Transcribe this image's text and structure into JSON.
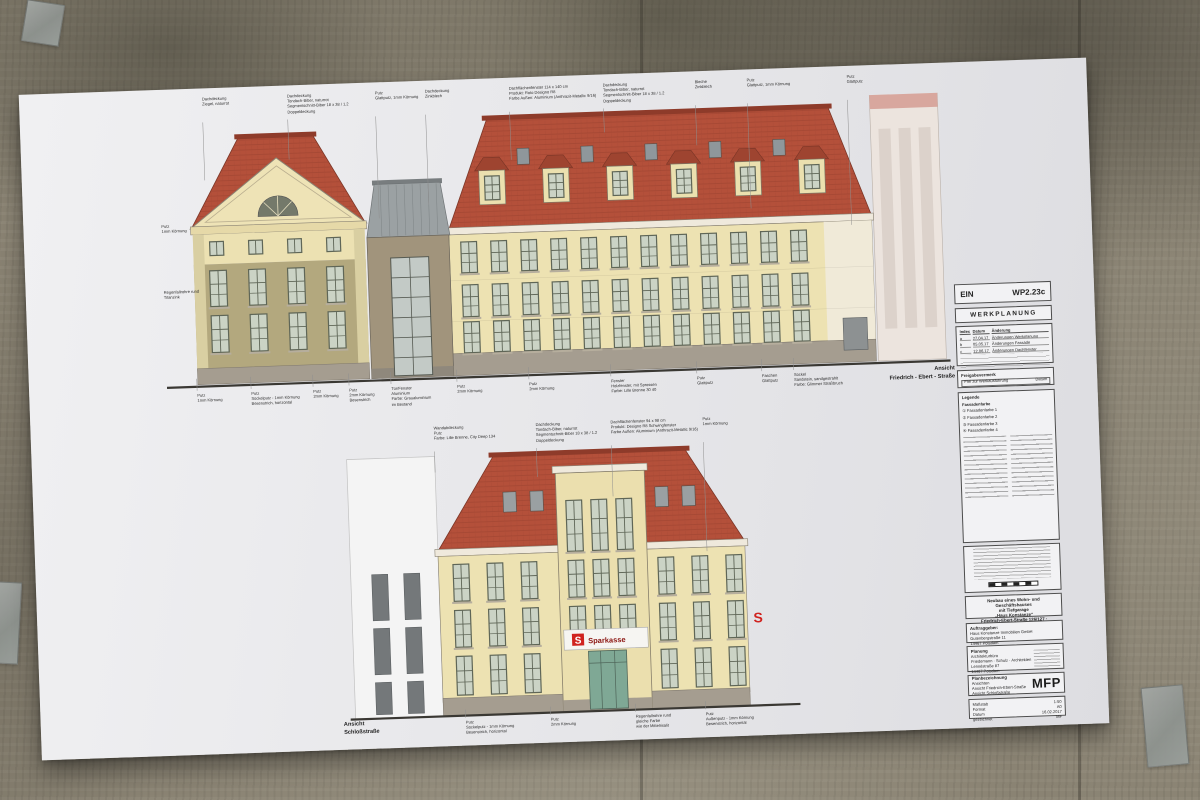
{
  "scene": {
    "description": "Werkplanung sheet taped to concrete wall"
  },
  "colors": {
    "roof_red": "#b4503a",
    "roof_ridge": "#8e3b2a",
    "facade_cream": "#ede2b2",
    "tower_tan": "#b3a87e",
    "link_grey": "#a1947c",
    "metal_roof": "#9ba1a3",
    "base_grey": "#a59d90",
    "window_frame": "#5f6657",
    "window_glass": "#cbd3c5",
    "sparkasse_red": "#d0231f",
    "entrance_green": "#7fa895",
    "paper": "#e9e9eb"
  },
  "elevation_top": {
    "view_label": {
      "line1": "Ansicht",
      "line2": "Friedrich - Ebert - Straße"
    },
    "annotations_top": [
      {
        "x": 213,
        "ly": 168,
        "lines": [
          "Dachdeckung",
          "Ziegel, naturrot"
        ]
      },
      {
        "x": 298,
        "ly": 150,
        "lines": [
          "Dachdeckung",
          "Tondach-Biber, naturrot",
          "Segmentschnitt-Biber 18 x 38 / 1.2",
          "Doppeldeckung"
        ]
      },
      {
        "x": 386,
        "ly": 212,
        "lines": [
          "Putz",
          "Glattputz, 1mm Körnung"
        ]
      },
      {
        "x": 436,
        "ly": 200,
        "lines": [
          "Dachdeckung",
          "Zinkblech"
        ]
      },
      {
        "x": 520,
        "ly": 158,
        "lines": [
          "Dachflächenfenster 114 x 140 cm",
          "Produkt: Roto Designo R8",
          "Farbe Außen: Aluminium (Anthrazit-Metallic 9/16)"
        ]
      },
      {
        "x": 614,
        "ly": 134,
        "lines": [
          "Dachdeckung",
          "Tondach-Biber, naturrot",
          "Segmentschnitt-Biber 18 x 38 / 1.2",
          "Doppeldeckung"
        ]
      },
      {
        "x": 706,
        "ly": 150,
        "lines": [
          "Bleche",
          "Zinkblech"
        ]
      },
      {
        "x": 758,
        "ly": 215,
        "lines": [
          "Putz",
          "Glattputz, 1mm Körnung"
        ]
      },
      {
        "x": 858,
        "ly": 235,
        "lines": [
          "Putz",
          "Glattputz"
        ]
      }
    ],
    "annotations_left": [
      {
        "x": 168,
        "y": 210,
        "lines": [
          "Putz",
          "1mm Körnung"
        ]
      },
      {
        "x": 168,
        "y": 276,
        "lines": [
          "Regenfallrohre rund",
          "Titanzink"
        ]
      }
    ],
    "annotations_bottom": [
      {
        "x": 198,
        "lines": [
          "Putz",
          "1mm Körnung"
        ]
      },
      {
        "x": 252,
        "lines": [
          "Putz",
          "Sockelputz - 1mm Körnung",
          "Besenstrich, horizontal"
        ]
      },
      {
        "x": 314,
        "lines": [
          "Putz",
          "2mm Körnung"
        ]
      },
      {
        "x": 350,
        "lines": [
          "Putz",
          "2mm Körnung",
          "Besenstrich"
        ]
      },
      {
        "x": 392,
        "lines": [
          "Tür/Fenster",
          "Aluminium",
          "Farbe: Graualuminium",
          "im Bestand"
        ]
      },
      {
        "x": 458,
        "lines": [
          "Putz",
          "2mm Körnung"
        ]
      },
      {
        "x": 530,
        "lines": [
          "Putz",
          "2mm Körnung"
        ]
      },
      {
        "x": 612,
        "lines": [
          "Fenster",
          "Holzfenster, mit Sprossen",
          "Farbe: Lille Brenne 30 40"
        ]
      },
      {
        "x": 698,
        "lines": [
          "Putz",
          "Glattputz"
        ]
      },
      {
        "x": 763,
        "lines": [
          "Faschen",
          "Glattputz"
        ]
      },
      {
        "x": 795,
        "lines": [
          "Sockel",
          "Sandstein, sandgestrahlt",
          "Farbe: Glimmer Straßbruch"
        ]
      }
    ]
  },
  "elevation_bottom": {
    "view_label": {
      "line1": "Ansicht",
      "line2": "Schloßstraße"
    },
    "sign": {
      "text": "Sparkasse",
      "logo_letter": "S"
    },
    "annotations_top": [
      {
        "x": 433,
        "ly": 468,
        "lines": [
          "Wandabdeckung",
          "Putz",
          "Farbe: Lille Brenne, City Deep 134"
        ]
      },
      {
        "x": 535,
        "ly": 476,
        "lines": [
          "Dachdeckung",
          "Tondach-Biber, naturrot",
          "Segmentschnitt-Biber 18 x 38 / 1.2",
          "Doppeldeckung"
        ]
      },
      {
        "x": 610,
        "ly": 498,
        "lines": [
          "Dachflächenfenster 94 x 98 cm",
          "Produkt: Designo R8 Schwingfenster",
          "Farbe Außen: Aluminium (Anthrazit-Metallic 9/16)"
        ]
      },
      {
        "x": 702,
        "ly": 556,
        "lines": [
          "Putz",
          "1mm Körnung"
        ]
      }
    ],
    "annotations_bottom": [
      {
        "x": 455,
        "lines": [
          "Putz",
          "Sockelputz - 1mm Körnung",
          "Besenstrich, horizontal"
        ]
      },
      {
        "x": 540,
        "lines": [
          "Putz",
          "2mm Körnung"
        ]
      },
      {
        "x": 625,
        "lines": [
          "Regenfallrohre rund",
          "gleiche Farbe",
          "wie der Mittelrisalit"
        ]
      },
      {
        "x": 695,
        "lines": [
          "Putz",
          "Außenputz - 1mm Körnung",
          "Besenstrich, horizontal"
        ]
      }
    ]
  },
  "titleblock": {
    "code_left": "EIN",
    "code_right": "WP2.23c",
    "plan_type": "WERKPLANUNG",
    "revisions": {
      "headers": [
        "Index",
        "Datum",
        "Änderung"
      ],
      "rows": [
        [
          "a",
          "27.04.17",
          "Änderungen Werkplanung"
        ],
        [
          "b",
          "05.05.17",
          "Änderungen Fassade"
        ],
        [
          "c",
          "12.06.17",
          "Änderungen Dachfenster"
        ]
      ]
    },
    "freigabe": {
      "title": "Freigabevermerk",
      "line": "Frei zur Werkausführung",
      "right": "Datum"
    },
    "legende": {
      "title": "Legende",
      "subtitle": "Fassadenfarbe",
      "items": [
        "Fassadenfarbe 1",
        "Fassadenfarbe 2",
        "Fassadenfarbe 3",
        "Fassadenfarbe 4"
      ]
    },
    "project": {
      "lines": [
        "Neubau eines Wohn- und Geschäftshauses",
        "mit Tiefgarage",
        "„Haus Konstanze“",
        "Friedrich-Ebert-Straße 126/127 · Dorotheenstraße 1",
        "14467 Potsdam"
      ]
    },
    "auftraggeber": {
      "title": "Auftraggeber:",
      "lines": [
        "Haus Konstanze Immobilien GmbH",
        "Gutenbergstraße 11",
        "14467 Potsdam"
      ]
    },
    "planung": {
      "title": "Planung",
      "lines": [
        "Architekturbüro",
        "Friedemann · Schulz · Architekten",
        "Lennéstraße 87",
        "14467 Potsdam"
      ]
    },
    "planbezeichnung": {
      "title": "Planbezeichnung",
      "lines": [
        "Ansichten",
        "Ansicht Friedrich-Ebert-Straße",
        "Ansicht Schloßstraße"
      ],
      "logo": "MFP"
    },
    "info": {
      "rows": [
        [
          "Maßstab",
          "1:50"
        ],
        [
          "Format",
          "A0"
        ],
        [
          "Datum",
          "16.02.2017"
        ],
        [
          "gezeichnet",
          "MF"
        ]
      ]
    }
  }
}
